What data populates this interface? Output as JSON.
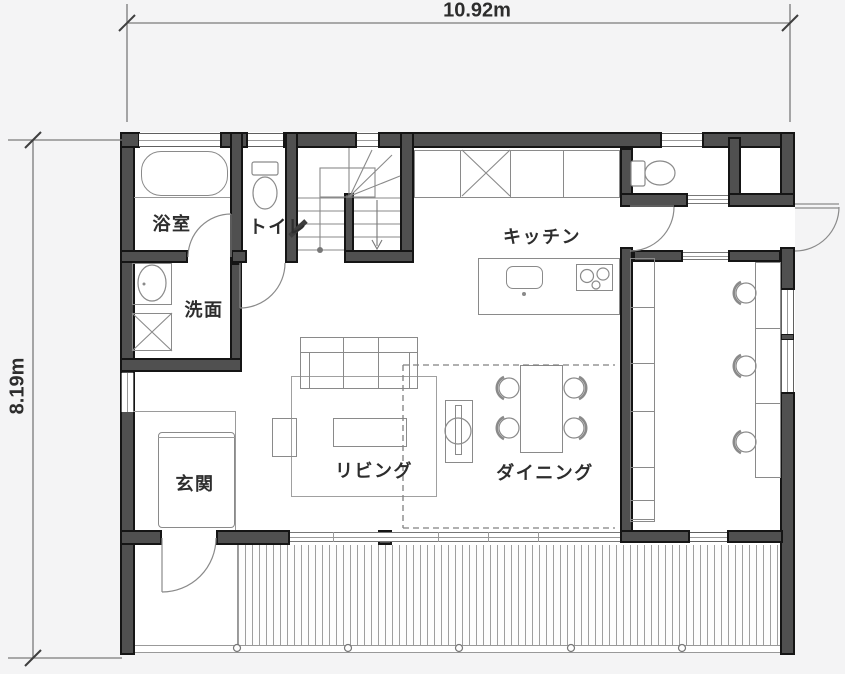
{
  "plan": {
    "type": "floor-plan",
    "rooms": {
      "bathroom": {
        "label": "浴室"
      },
      "toilet": {
        "label": "トイレ"
      },
      "washroom": {
        "label": "洗面"
      },
      "kitchen": {
        "label": "キッチン"
      },
      "entrance": {
        "label": "玄関"
      },
      "living": {
        "label": "リビング"
      },
      "dining": {
        "label": "ダイニング"
      }
    },
    "dimensions": {
      "width": {
        "label": "10.92m"
      },
      "height": {
        "label": "8.19m"
      }
    },
    "fixtures": [
      "bathtub",
      "toilet",
      "washbasin",
      "washing-machine",
      "staircase",
      "refrigerator",
      "kitchen-sink",
      "cooktop",
      "island-counter",
      "dining-table",
      "dining-chair",
      "sofa",
      "coffee-table",
      "side-table",
      "area-rug",
      "column-unit",
      "entrance-step",
      "bookshelf",
      "study-desk",
      "desk-chair",
      "storage-closet",
      "wood-deck",
      "deck-post"
    ],
    "colors": {
      "wall": "#505050",
      "wall_edge": "#151515",
      "fixture_line": "#8a8a8a",
      "background": "#f4f4f5",
      "floor": "#ffffff",
      "text": "#2d2d2d"
    }
  }
}
